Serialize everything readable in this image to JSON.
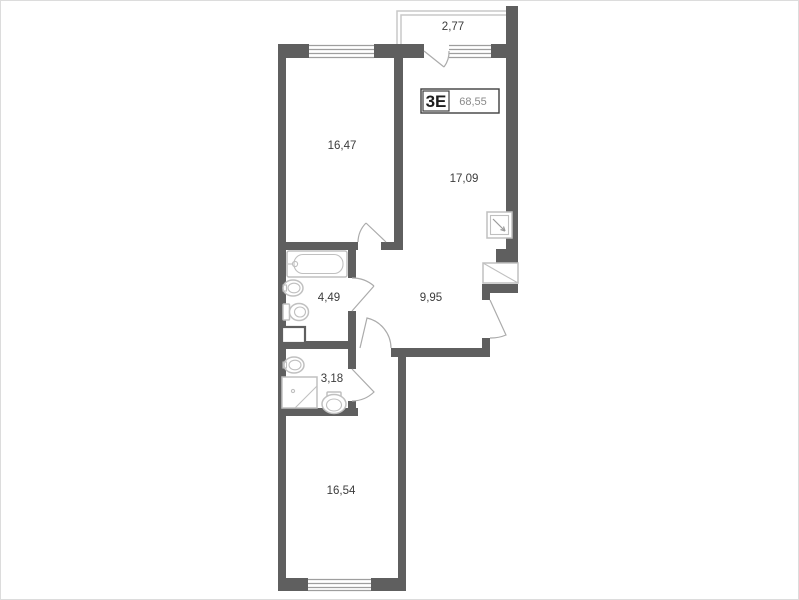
{
  "unit": {
    "type_label": "3Е",
    "total_area": "68,55"
  },
  "rooms": [
    {
      "name": "balcony",
      "area": "2,77"
    },
    {
      "name": "room-top-left",
      "area": "16,47"
    },
    {
      "name": "kitchen-living",
      "area": "17,09"
    },
    {
      "name": "bathroom",
      "area": "4,49"
    },
    {
      "name": "hallway",
      "area": "9,95"
    },
    {
      "name": "wc",
      "area": "3,18"
    },
    {
      "name": "room-bottom",
      "area": "16,54"
    }
  ],
  "colors": {
    "wall": "#5f5f5f",
    "window_line": "#9e9e9e",
    "door_line": "#ababab",
    "fixture_line": "#c0c0c0",
    "balcony_line": "#c9c9c9",
    "text": "#3c3c3c",
    "area_value": "#8a8a8a",
    "background": "#ffffff",
    "frame_border": "#dcdcdc"
  }
}
